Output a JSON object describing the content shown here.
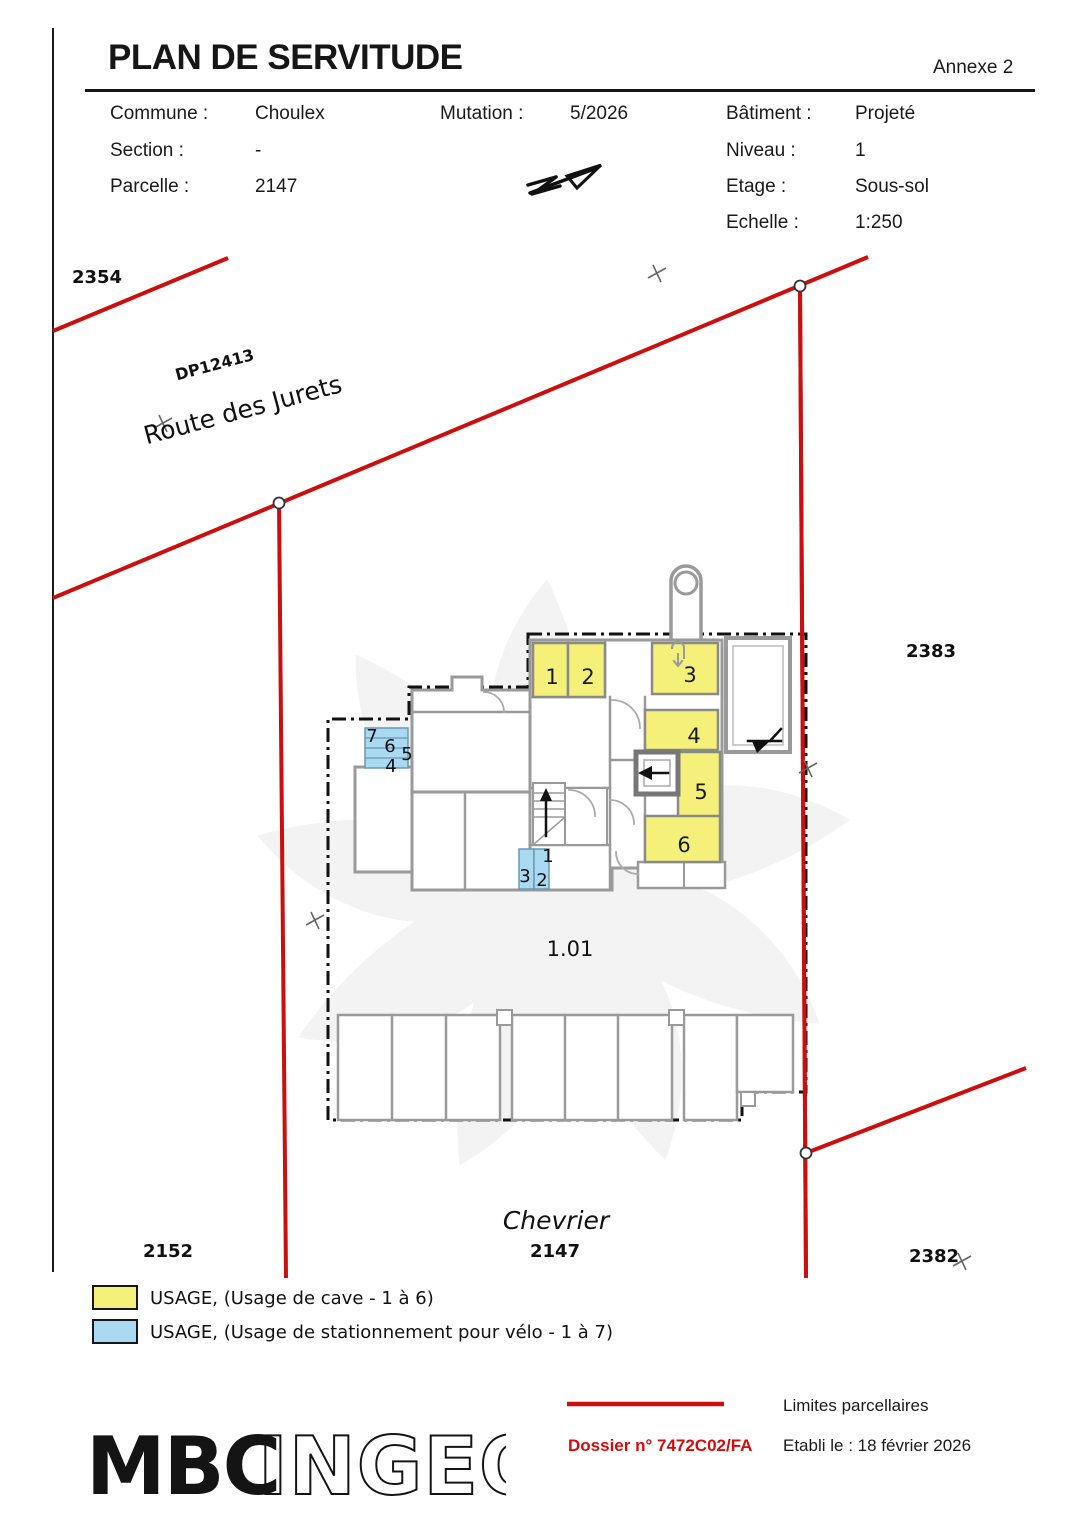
{
  "header": {
    "title": "PLAN DE SERVITUDE",
    "annex": "Annexe 2",
    "commune_label": "Commune :",
    "commune": "Choulex",
    "mutation_label": "Mutation :",
    "mutation": "5/2026",
    "batiment_label": "Bâtiment :",
    "batiment": "Projeté",
    "section_label": "Section :",
    "section": "-",
    "niveau_label": "Niveau :",
    "niveau": "1",
    "parcelle_label": "Parcelle :",
    "parcelle": "2147",
    "etage_label": "Etage :",
    "etage": "Sous-sol",
    "echelle_label": "Echelle :",
    "echelle": "1:250"
  },
  "map": {
    "parcels": {
      "top_left": "2354",
      "right": "2383",
      "bottom_left": "2152",
      "bottom_center": "2147",
      "bottom_right": "2382"
    },
    "road_ref": "DP12413",
    "road_name": "Route des Jurets",
    "locality": "Chevrier",
    "building_ref": "1.01",
    "cave_rooms": [
      "1",
      "2",
      "3",
      "4",
      "5",
      "6"
    ],
    "bike_slots_left": [
      "7",
      "6",
      "5",
      "4"
    ],
    "bike_slots_center": [
      "3",
      "2",
      "1"
    ]
  },
  "legend": {
    "cave_label": "USAGE, (Usage de cave - 1 à 6)",
    "bike_label": "USAGE, (Usage de stationnement pour vélo - 1 à 7)",
    "cave_color": "#f5f07a",
    "bike_color": "#a9daf2"
  },
  "footer": {
    "limits_label": "Limites parcellaires",
    "dossier": "Dossier n° 7472C02/FA",
    "established": "Etabli le : 18 février 2026",
    "logo_solid": "MBC",
    "logo_outline": "INGEO"
  },
  "colors": {
    "boundary_red": "#cb0e0e",
    "dossier_red": "#d40c0c",
    "wall_gray": "#9a9a9a"
  }
}
